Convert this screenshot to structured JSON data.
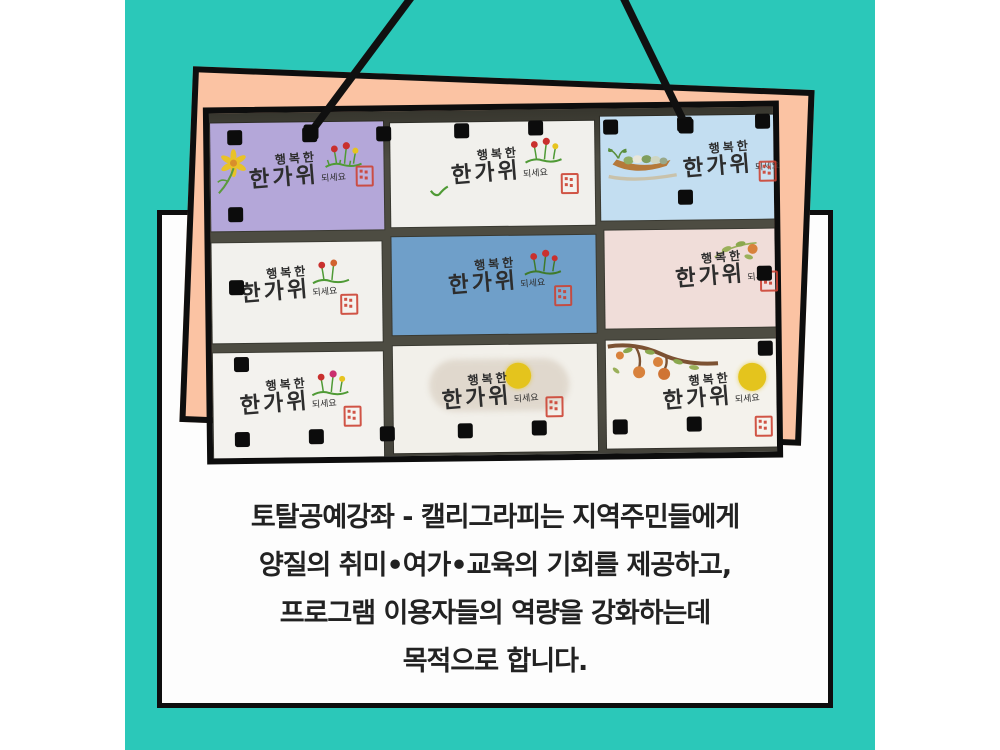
{
  "canvas": {
    "background": "#ffffff",
    "teal_panel_color": "#2bc8b9"
  },
  "hanging": {
    "string_color": "#101010"
  },
  "backing_paper": {
    "color": "#fbc3a3",
    "border_color": "#0e0e0e"
  },
  "photo_board": {
    "mat_color": "#4d4c42",
    "magnet_color": "#0c0c0c",
    "seal_color": "#cd4434",
    "moon_color": "#e4c41d",
    "greeting": {
      "top": "행복한",
      "main": "한가위",
      "small": "되세요"
    },
    "cards": [
      {
        "position": "row1-col1",
        "bg": "#b4a7d9",
        "decorations": [
          "yellow-flower",
          "tulips",
          "seal-stamp"
        ]
      },
      {
        "position": "row1-col2",
        "bg": "#f1f0ec",
        "decorations": [
          "sprout",
          "tulips",
          "seal-stamp"
        ]
      },
      {
        "position": "row1-col3",
        "bg": "#c3def1",
        "decorations": [
          "fruit-boat",
          "seal-stamp"
        ]
      },
      {
        "position": "row2-col1",
        "bg": "#f2f1ed",
        "decorations": [
          "tulips",
          "seal-stamp"
        ]
      },
      {
        "position": "row2-col2",
        "bg": "#6f9fc9",
        "decorations": [
          "tulips",
          "seal-stamp"
        ]
      },
      {
        "position": "row2-col3",
        "bg": "#f0ddd9",
        "decorations": [
          "autumn-leaves",
          "seal-stamp"
        ]
      },
      {
        "position": "row3-col1",
        "bg": "#f3f2ee",
        "decorations": [
          "tulips",
          "seal-stamp"
        ]
      },
      {
        "position": "row3-col2",
        "bg": "#f2f0ea",
        "decorations": [
          "ink-wash",
          "full-moon",
          "seal-stamp"
        ]
      },
      {
        "position": "row3-col3",
        "bg": "#f4f2ec",
        "decorations": [
          "persimmon-branch",
          "full-moon",
          "seal-stamp"
        ]
      }
    ]
  },
  "caption": {
    "text_color": "#222222",
    "card_background": "#fdfdfd",
    "border_color": "#0e0e0e",
    "lines": [
      "토탈공예강좌 - 캘리그라피는 지역주민들에게",
      "양질의 취미•여가•교육의 기회를 제공하고,",
      "프로그램 이용자들의 역량을 강화하는데",
      "목적으로 합니다."
    ]
  }
}
